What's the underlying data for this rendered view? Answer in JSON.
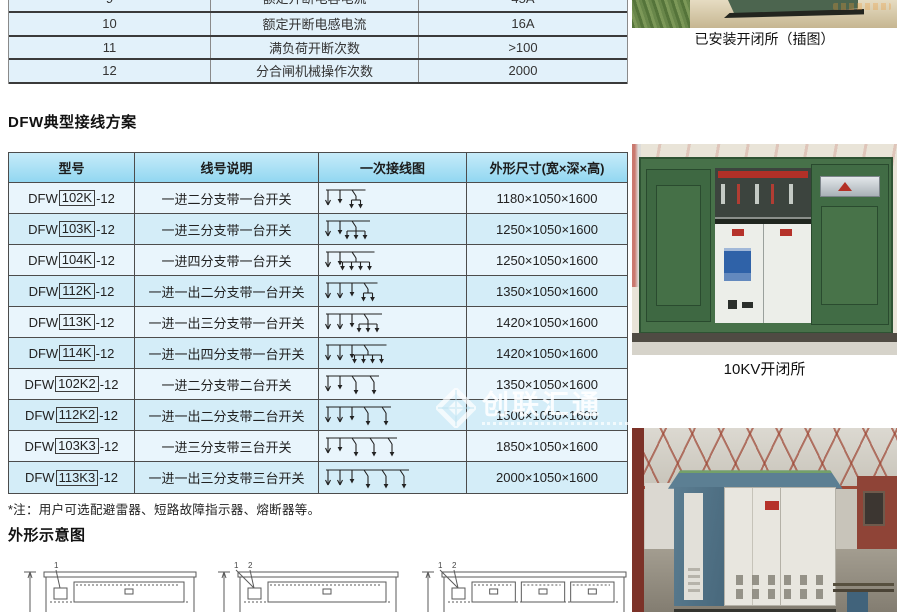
{
  "spec_table": {
    "rows": [
      {
        "num": "9",
        "name": "额定开断电容电流",
        "value": "45A"
      },
      {
        "num": "10",
        "name": "额定开断电感电流",
        "value": "16A"
      },
      {
        "num": "11",
        "name": "满负荷开断次数",
        "value": ">100"
      },
      {
        "num": "12",
        "name": "分合闸机械操作次数",
        "value": "2000"
      }
    ]
  },
  "wiring_section": {
    "title": "DFW典型接线方案",
    "headers": [
      "型号",
      "线号说明",
      "一次接线图",
      "外形尺寸(宽×深×高)"
    ],
    "rows": [
      {
        "model_prefix": "DFW",
        "model_code": "102K",
        "model_suffix": "-12",
        "desc": "一进二分支带一台开关",
        "dim": "1180×1050×1600",
        "diagram": {
          "feeders": 1,
          "outs": 0,
          "drops": 1,
          "groups": [
            2
          ]
        }
      },
      {
        "model_prefix": "DFW",
        "model_code": "103K",
        "model_suffix": "-12",
        "desc": "一进三分支带一台开关",
        "dim": "1250×1050×1600",
        "diagram": {
          "feeders": 1,
          "outs": 0,
          "drops": 1,
          "groups": [
            3
          ]
        }
      },
      {
        "model_prefix": "DFW",
        "model_code": "104K",
        "model_suffix": "-12",
        "desc": "一进四分支带一台开关",
        "dim": "1250×1050×1600",
        "diagram": {
          "feeders": 1,
          "outs": 0,
          "drops": 1,
          "groups": [
            4
          ]
        }
      },
      {
        "model_prefix": "DFW",
        "model_code": "112K",
        "model_suffix": "-12",
        "desc": "一进一出二分支带一台开关",
        "dim": "1350×1050×1600",
        "diagram": {
          "feeders": 1,
          "outs": 1,
          "drops": 1,
          "groups": [
            2
          ]
        }
      },
      {
        "model_prefix": "DFW",
        "model_code": "113K",
        "model_suffix": "-12",
        "desc": "一进一出三分支带一台开关",
        "dim": "1420×1050×1600",
        "diagram": {
          "feeders": 1,
          "outs": 1,
          "drops": 1,
          "groups": [
            3
          ]
        }
      },
      {
        "model_prefix": "DFW",
        "model_code": "114K",
        "model_suffix": "-12",
        "desc": "一进一出四分支带一台开关",
        "dim": "1420×1050×1600",
        "diagram": {
          "feeders": 1,
          "outs": 1,
          "drops": 1,
          "groups": [
            4
          ]
        }
      },
      {
        "model_prefix": "DFW",
        "model_code": "102K2",
        "model_suffix": "-12",
        "desc": "一进二分支带二台开关",
        "dim": "1350×1050×1600",
        "diagram": {
          "feeders": 1,
          "outs": 0,
          "drops": 1,
          "groups": [
            1,
            1
          ]
        }
      },
      {
        "model_prefix": "DFW",
        "model_code": "112K2",
        "model_suffix": "-12",
        "desc": "一进一出二分支带二台开关",
        "dim": "1500×1050×1600",
        "diagram": {
          "feeders": 1,
          "outs": 1,
          "drops": 1,
          "groups": [
            1,
            1
          ]
        }
      },
      {
        "model_prefix": "DFW",
        "model_code": "103K3",
        "model_suffix": "-12",
        "desc": "一进三分支带三台开关",
        "dim": "1850×1050×1600",
        "diagram": {
          "feeders": 1,
          "outs": 0,
          "drops": 1,
          "groups": [
            1,
            1,
            1
          ]
        }
      },
      {
        "model_prefix": "DFW",
        "model_code": "113K3",
        "model_suffix": "-12",
        "desc": "一进一出三分支带三台开关",
        "dim": "2000×1050×1600",
        "diagram": {
          "feeders": 1,
          "outs": 1,
          "drops": 1,
          "groups": [
            1,
            1,
            1
          ]
        }
      }
    ]
  },
  "note": "*注：用户可选配避雷器、短路故障指示器、熔断器等。",
  "outline_section": {
    "title": "外形示意图"
  },
  "outline_drawings": [
    {
      "labels": [
        "1"
      ],
      "panels": 1
    },
    {
      "labels": [
        "2",
        "1"
      ],
      "panels": 1
    },
    {
      "labels": [
        "2",
        "1"
      ],
      "panels": 3
    }
  ],
  "photos": {
    "installed": {
      "caption": "已安装开闭所（插图）"
    },
    "open_cabinet": {
      "caption": "10KV开闭所"
    }
  },
  "watermark": {
    "text": "创联汇通"
  },
  "colors": {
    "table_header_blue": "#92d7f1",
    "row_light": "#e9f5fc",
    "row_dark": "#d4edf8",
    "cabinet_green": "#477149",
    "cabinet_blue": "#5c7f93"
  }
}
